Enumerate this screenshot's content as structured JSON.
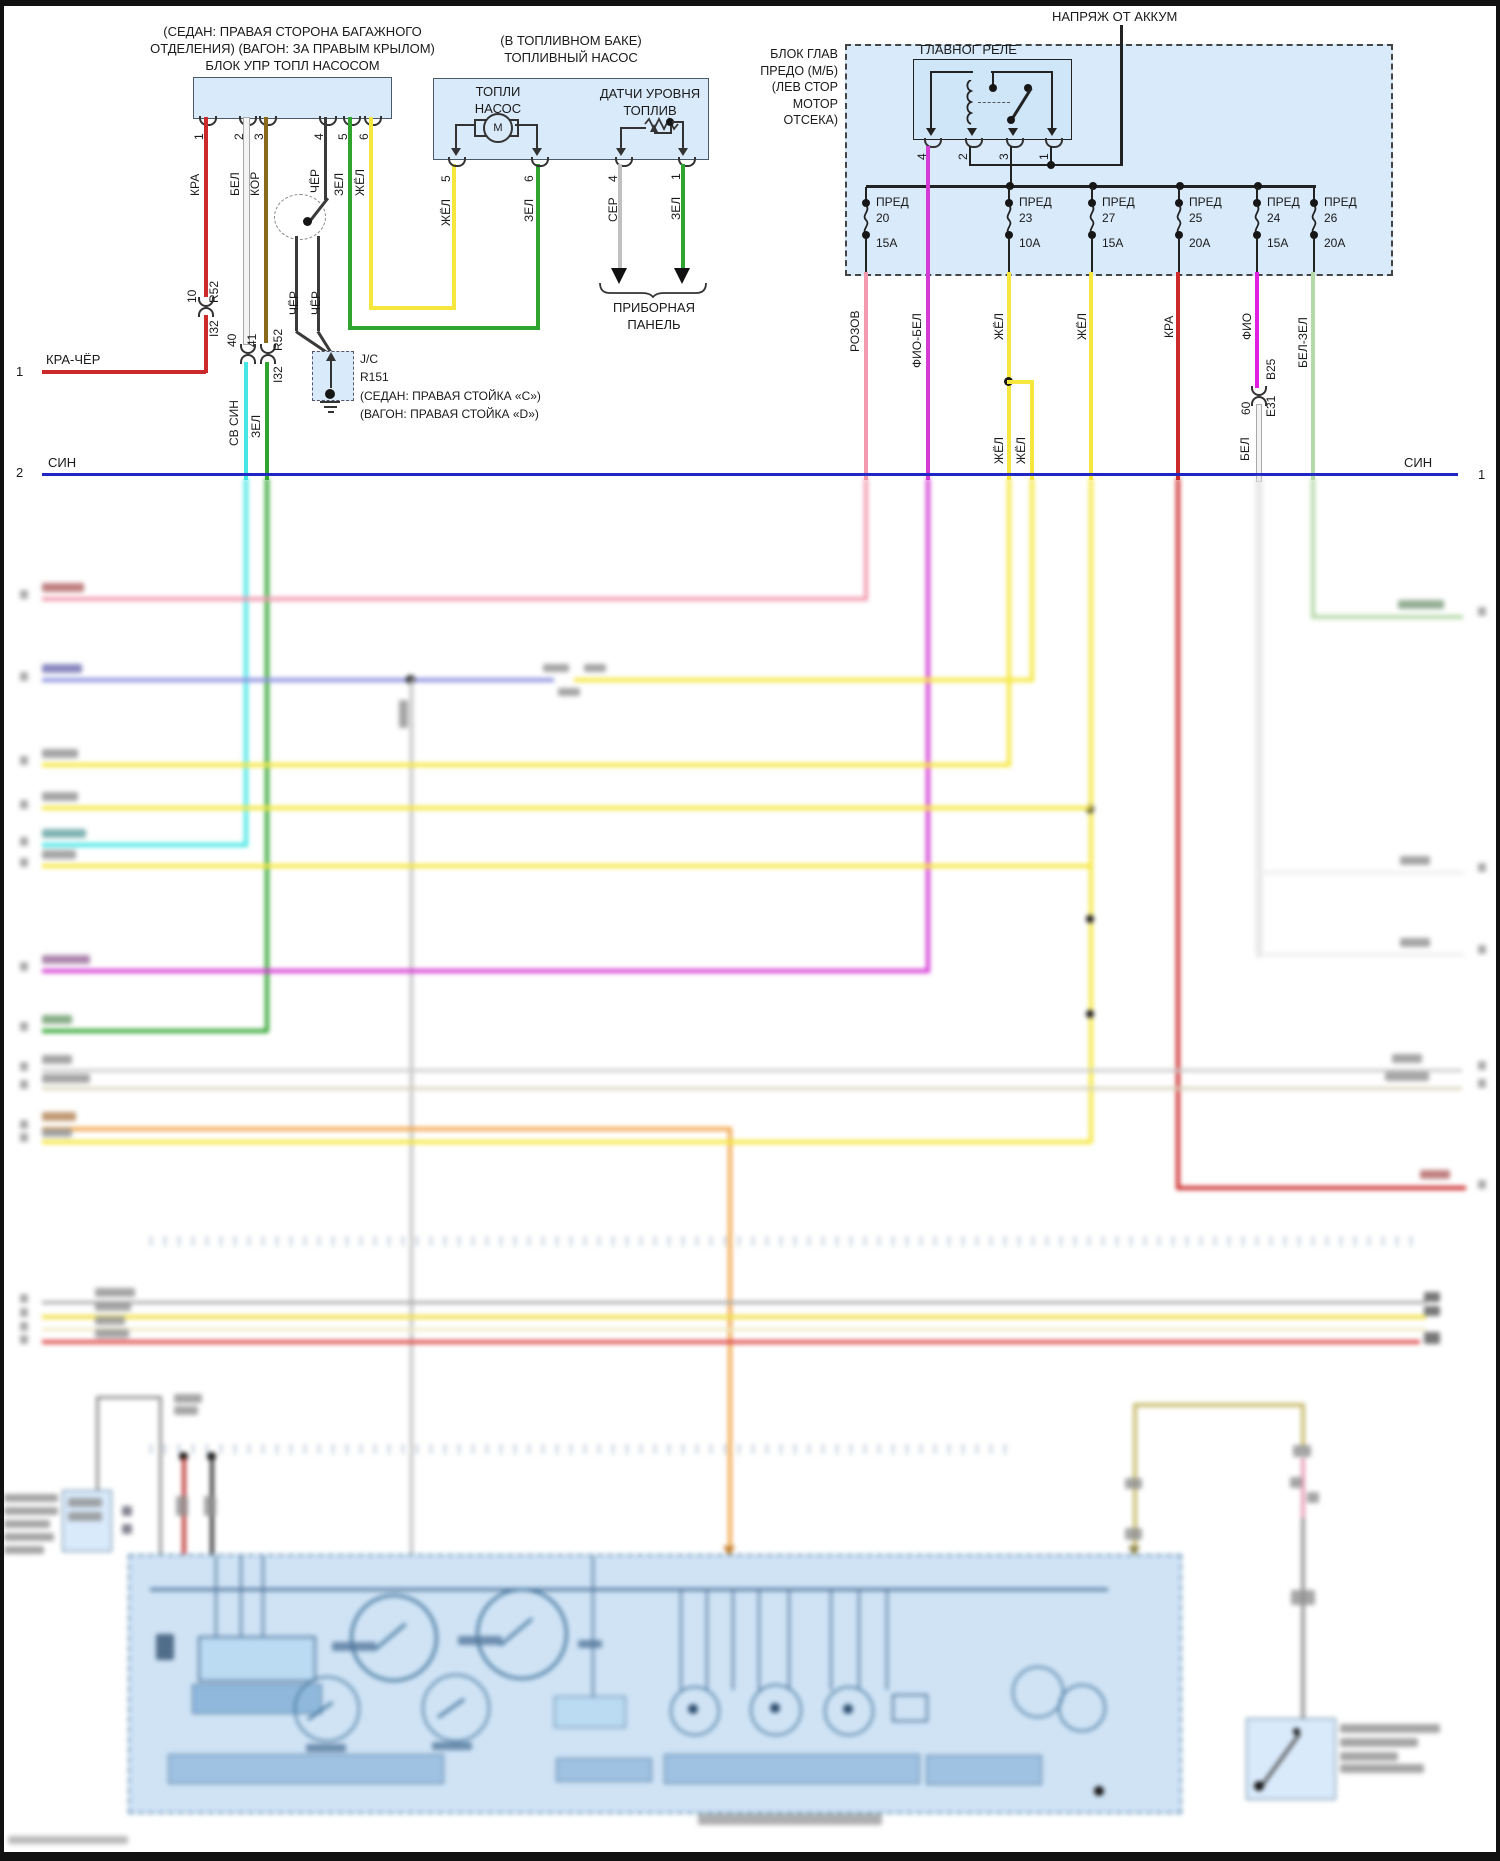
{
  "colors": {
    "red": "#cc2a2a",
    "white_wire": "#f4f4f4",
    "brown": "#8a6a1a",
    "black": "#3a3a3a",
    "green": "#2fa52f",
    "yellow": "#f5e73d",
    "cyan": "#45e6e6",
    "blue": "#2026c4",
    "pink": "#f29ab0",
    "magenta": "#d43ad4",
    "violet": "#8d92e0",
    "grey": "#bdbdbd",
    "orange": "#f2a84e",
    "olive": "#c9bd72",
    "pale_green": "#b5d9a8",
    "block_fill": "#d9eafb",
    "panel_fill": "#cfe3f5",
    "panel_border": "#6b94b9"
  },
  "tlb": {
    "title_lines": [
      "(СЕДАН: ПРАВАЯ СТОРОНА БАГАЖНОГО",
      "ОТДЕЛЕНИЯ) (ВАГОН: ЗА ПРАВЫМ КРЫЛОМ)",
      "БЛОК УПР ТОПЛ НАСОСОМ"
    ],
    "pin_nums": [
      "1",
      "2",
      "3",
      "4",
      "5",
      "6"
    ],
    "wire_labels": [
      "КРА",
      "БЕЛ",
      "КОР",
      "ЧЁР",
      "ЗЕЛ",
      "ЖЁЛ"
    ],
    "conn1": {
      "pin": "10",
      "name": "R52",
      "dest": "I32"
    },
    "conn2": {
      "pin": "40"
    },
    "conn3": {
      "pin": "41",
      "name": "R52",
      "dest": "I32"
    },
    "sub_labels": {
      "cyan": "СВ СИН",
      "green": "ЗЕЛ",
      "black1": "ЧЁР",
      "black2": "ЧЁР"
    },
    "jc": [
      "J/C",
      "R151",
      "(СЕДАН: ПРАВАЯ СТОЙКА «C»)",
      "(ВАГОН: ПРАВАЯ СТОЙКА «D»)"
    ]
  },
  "rows": {
    "r1": {
      "num": "1",
      "label": "КРА-ЧЁР"
    },
    "r2": {
      "num_left": "2",
      "label_left": "СИН",
      "label_right": "СИН",
      "num_right": "1"
    }
  },
  "pump": {
    "title_lines": [
      "(В ТОПЛИВНОМ БАКЕ)",
      "ТОПЛИВНЫЙ НАСОС"
    ],
    "pump_lines": [
      "ТОПЛИ",
      "НАСОС"
    ],
    "motor": "М",
    "sensor_lines": [
      "ДАТЧИ УРОВНЯ",
      "ТОПЛИВ"
    ],
    "pin_nums": [
      "5",
      "6",
      "4",
      "1"
    ],
    "pin_labels": [
      "ЖЁЛ",
      "ЗЕЛ",
      "СЕР",
      "ЗЕЛ"
    ],
    "dest_lines": [
      "ПРИБОРНАЯ",
      "ПАНЕЛЬ"
    ]
  },
  "fb": {
    "feed_label": "НАПРЯЖ ОТ АККУМ",
    "block_lines": [
      "БЛОК ГЛАВ",
      "ПРЕДО (М/Б)",
      "(ЛЕВ СТОР",
      "МОТОР",
      "ОТСЕКА)"
    ],
    "relay_label": "ГЛАВНОГ РЕЛЕ",
    "relay_pins": [
      "4",
      "2",
      "3",
      "1"
    ],
    "fuses": [
      {
        "name": "ПРЕД",
        "num": "20",
        "amps": "15А"
      },
      {
        "name": "ПРЕД",
        "num": "23",
        "amps": "10А"
      },
      {
        "name": "ПРЕД",
        "num": "27",
        "amps": "15А"
      },
      {
        "name": "ПРЕД",
        "num": "25",
        "amps": "20А"
      },
      {
        "name": "ПРЕД",
        "num": "24",
        "amps": "15А"
      },
      {
        "name": "ПРЕД",
        "num": "26",
        "amps": "20А"
      }
    ],
    "wire_labels": [
      "РОЗОВ",
      "ФИО-БЕЛ",
      "ЖЁЛ",
      "ЖЁЛ",
      "КРА",
      "ФИО",
      "БЕЛ-ЗЕЛ"
    ],
    "branch_labels": [
      "ЖЁЛ",
      "ЖЁЛ"
    ],
    "conn": {
      "pin": "60",
      "name": "E31",
      "dest": "B25"
    },
    "bel_label": "БЕЛ"
  }
}
